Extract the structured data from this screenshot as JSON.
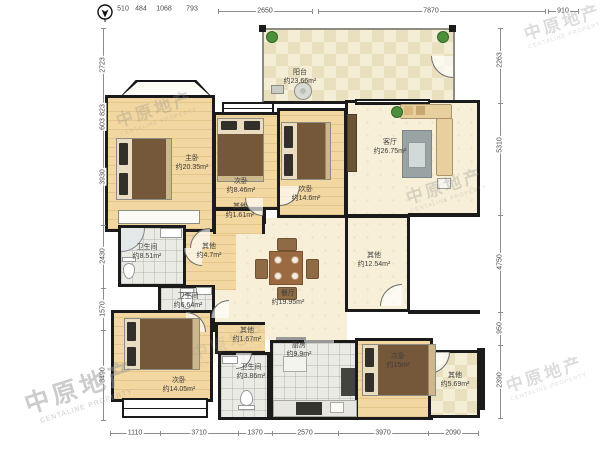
{
  "watermark": {
    "cn": "中原地产",
    "en": "CENTALINE PROPERTY"
  },
  "dims": {
    "top": [
      "510",
      "484",
      "1068",
      "793",
      "2650",
      "7870",
      "910"
    ],
    "left": [
      "2723",
      "823",
      "603",
      "3930",
      "2430",
      "1570",
      "3490"
    ],
    "right": [
      "2263",
      "5310",
      "4750",
      "950",
      "2390"
    ],
    "bottom": [
      "1110",
      "3710",
      "1370",
      "2570",
      "3970",
      "2090"
    ]
  },
  "rooms": {
    "balcony": {
      "name": "阳台",
      "area": "约23.66m²"
    },
    "living": {
      "name": "客厅",
      "area": "约26.75m²"
    },
    "master": {
      "name": "主卧",
      "area": "约20.35m²"
    },
    "bed2": {
      "name": "次卧",
      "area": "约8.46m²"
    },
    "bed3": {
      "name": "次卧",
      "area": "约14.6m²"
    },
    "other161": {
      "name": "其他",
      "area": "约1.61m²"
    },
    "other47": {
      "name": "其他",
      "area": "约4.7m²"
    },
    "bath851": {
      "name": "卫生间",
      "area": "约8.51m²"
    },
    "bath664": {
      "name": "卫生间",
      "area": "约6.64m²"
    },
    "dining": {
      "name": "餐厅",
      "area": "约19.95m²"
    },
    "other1254": {
      "name": "其他",
      "area": "约12.54m²"
    },
    "bed4": {
      "name": "次卧",
      "area": "约14.05m²"
    },
    "other167": {
      "name": "其他",
      "area": "约1.67m²"
    },
    "bath386": {
      "name": "卫生间",
      "area": "约3.86m²"
    },
    "kitchen": {
      "name": "厨房",
      "area": "约9.9m²"
    },
    "bed5": {
      "name": "次卧",
      "area": "约15m²"
    },
    "other569": {
      "name": "其他",
      "area": "约5.69m²"
    }
  }
}
